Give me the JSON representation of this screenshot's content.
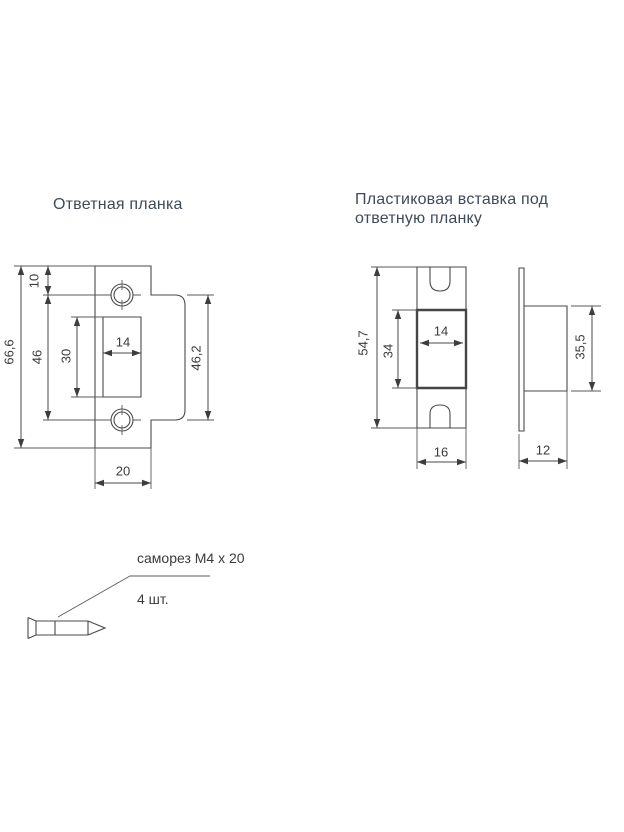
{
  "sections": {
    "strike_plate": {
      "title": "Ответная планка",
      "dims": {
        "overall_height": "66,6",
        "top_hole_offset": "10",
        "hole_spacing": "46",
        "cutout_height": "30",
        "cutout_width": "14",
        "tab_height": "46,2",
        "plate_width": "20"
      }
    },
    "insert": {
      "title": "Пластиковая вставка под ответную планку",
      "front_dims": {
        "height": "54,7",
        "opening_height": "34",
        "opening_width": "14",
        "width": "16"
      },
      "side_dims": {
        "height": "35,5",
        "depth": "12"
      }
    },
    "screw": {
      "label": "саморез M4 x 20",
      "quantity": "4 шт."
    }
  },
  "colors": {
    "line": "#4a4a4a",
    "dim_text": "#3b3b3b",
    "title_text": "#3e4a59",
    "background": "#ffffff"
  }
}
